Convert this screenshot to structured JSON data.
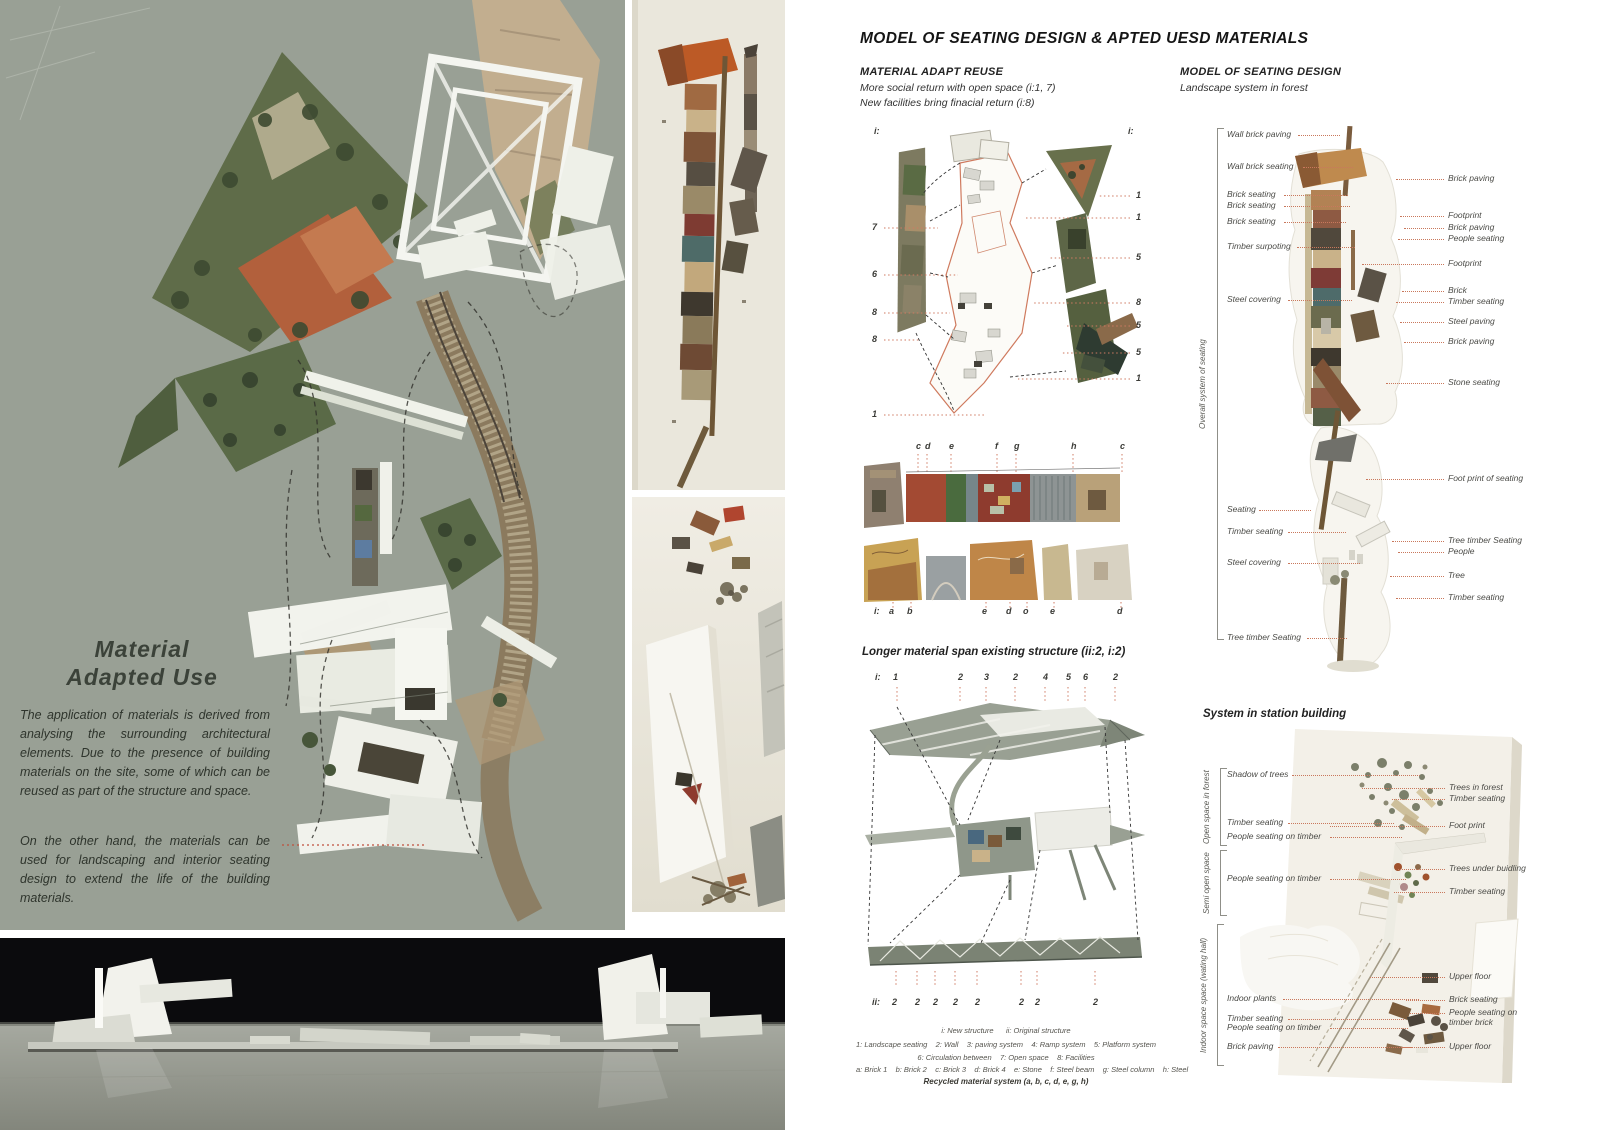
{
  "left_panel": {
    "heading1": "Material",
    "heading2": "Adapted Use",
    "para1": "The application of materials is derived from analysing the surrounding architectural elements. Due to the presence of building materials on the site, some of which can be reused as part of the structure and space.",
    "para2": "On the other hand, the materials can be used for landscaping and interior seating design to extend the life of the building materials."
  },
  "title": "MODEL OF SEATING DESIGN & APTED UESD MATERIALS",
  "adapt": {
    "heading": "MATERIAL ADAPT REUSE",
    "sub1": "More social return with open space (i:1, 7)",
    "sub2": "New facilities bring finacial return (i:8)",
    "left_nums": [
      "i:",
      "7",
      "6",
      "8",
      "8",
      "1"
    ],
    "right_nums": [
      "i:",
      "1",
      "1",
      "5",
      "8",
      "5",
      "5",
      "1"
    ],
    "top_letters": [
      "c",
      "d",
      "e",
      "f",
      "g",
      "h",
      "c"
    ],
    "bottom_letters": [
      "i:",
      "a",
      "b",
      "e",
      "d",
      "o",
      "e",
      "d"
    ]
  },
  "span": {
    "heading": "Longer material span existing structure (ii:2, i:2)",
    "top_nums": [
      "i:",
      "1",
      "2",
      "3",
      "2",
      "4",
      "5",
      "6",
      "2"
    ],
    "bottom_nums": [
      "ii:",
      "2",
      "2",
      "2",
      "2",
      "2",
      "2",
      "2",
      "2"
    ]
  },
  "legend": {
    "line1": "i: New structure      ii: Original structure",
    "line2": "1: Landscape seating    2: Wall    3: paving system    4: Ramp system    5: Platform system",
    "line3": "6: Circulation between    7: Open space    8: Facilities",
    "line4": "a: Brick 1    b: Brick 2    c: Brick 3    d: Brick 4    e: Stone    f: Steel beam    g: Steel column    h: Steel",
    "line5": "Recycled material system (a, b, c, d, e, g, h)"
  },
  "seating": {
    "heading": "MODEL OF SEATING DESIGN",
    "sub": "Landscape system in forest",
    "bracket": "Overall system of seating",
    "left": [
      "Wall brick paving",
      "Wall brick seating",
      "Brick seating",
      "Brick seating",
      "Brick seating",
      "Timber surpoting",
      "Steel covering",
      "Seating",
      "Timber seating",
      "Steel covering",
      "Tree timber Seating"
    ],
    "right": [
      "Brick paving",
      "Footprint",
      "Brick paving",
      "People seating",
      "Footprint",
      "Brick",
      "Timber seating",
      "Steel paving",
      "Brick paving",
      "Stone seating",
      "Foot print of seating",
      "Tree timber Seating",
      "People",
      "Tree",
      "Timber seating"
    ]
  },
  "station": {
    "heading": "System in station building",
    "groups": [
      "Open space in forest",
      "Semi open space",
      "Indoor space space (wating hall)"
    ],
    "left": [
      "Shadow of trees",
      "Timber seating",
      "People seating on timber",
      "People seating on timber",
      "Indoor plants",
      "Timber seating",
      "People seating on timber",
      "Brick paving"
    ],
    "right": [
      "Trees in forest",
      "Timber seating",
      "Foot print",
      "Trees under buidling",
      "Timber seating",
      "Upper floor",
      "Brick seating",
      "People seating on timber brick",
      "Upper floor"
    ]
  },
  "colors": {
    "leader": "#c9785c",
    "model_board": "#99a095",
    "page": "#ffffff"
  }
}
